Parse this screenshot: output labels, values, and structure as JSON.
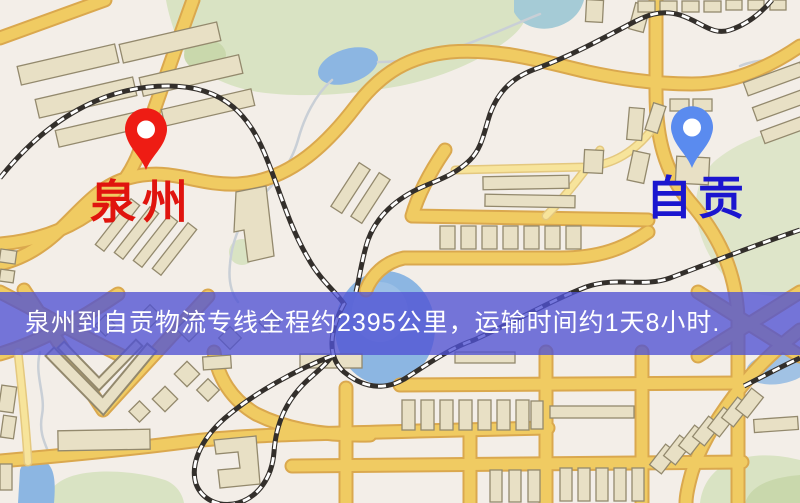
{
  "banner": {
    "text": "泉州到自贡物流专线全程约2395公里，运输时间约1天8小时."
  },
  "markers": [
    {
      "id": "origin",
      "label": "泉州"
    },
    {
      "id": "destination",
      "label": "自贡"
    }
  ],
  "colors": {
    "bg": "#f3eee8",
    "park": "#d9e3c3",
    "park-dark": "#c9d8ac",
    "water": "#8cb6e2",
    "water-soft": "#a5cbd6",
    "stream": "#c9cfd6",
    "road": "#f0cb62",
    "road-casing": "#daa84e",
    "road-light": "#f7e49b",
    "road-light-casing": "#e4c87f",
    "building": "#e8e0c5",
    "building-outline": "#93896d",
    "rail": "#332f2b",
    "marker-red": "#ee1c14",
    "marker-blue": "#5a8bef",
    "label-red": "#e0140e",
    "label-blue": "#1b16cf",
    "banner-bg": "rgba(80,82,212,0.78)",
    "banner-text": "#ffffff"
  }
}
